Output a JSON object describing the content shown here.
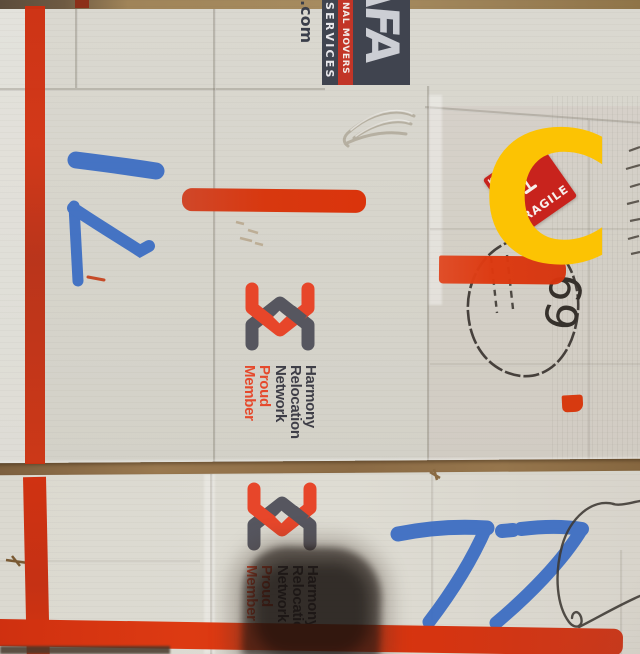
{
  "afa_logo": {
    "letters": "AFA",
    "movers": "NAL MOVERS",
    "services": "SERVICES",
    "domain": ".com"
  },
  "harmony_logo": {
    "l1": "Harmony",
    "l2": "Relocation",
    "l3": "Network",
    "l4": "Proud",
    "l5": "Member"
  },
  "fragile_sticker": {
    "label": "FRAGILE",
    "corner": "KI"
  },
  "annotation": {
    "letter": "C"
  },
  "handwriting": {
    "upper_left_number": "7",
    "lower_number": "77",
    "circled": "69"
  },
  "colors": {
    "tape_red": "#d8360f",
    "marker_blue": "#3a6cc3",
    "annotation_yellow": "#fcc303",
    "box_face": "#d7d5cc",
    "logo_navy": "#40444f",
    "harmony_orange": "#e7462a",
    "harmony_gray": "#56565f",
    "sticker_red": "#c8231d"
  }
}
